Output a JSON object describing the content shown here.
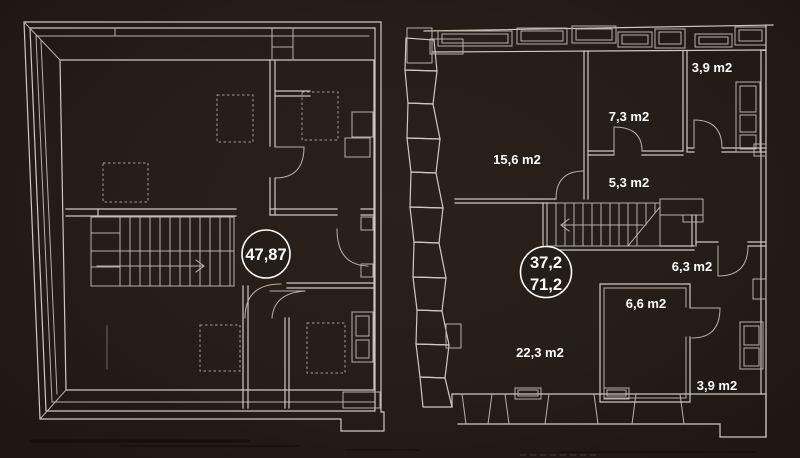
{
  "canvas": {
    "background": "#251d17",
    "line_color": "#cfc8bf",
    "text_color": "#ffffff"
  },
  "left_plan": {
    "total_area_badge": "47,87"
  },
  "right_plan": {
    "badge_line1": "37,2",
    "badge_line2": "71,2",
    "room_labels": [
      {
        "area": "3,9 m2"
      },
      {
        "area": "7,3 m2"
      },
      {
        "area": "15,6 m2"
      },
      {
        "area": "5,3 m2"
      },
      {
        "area": "6,3 m2"
      },
      {
        "area": "6,6 m2"
      },
      {
        "area": "22,3 m2"
      },
      {
        "area": "3,9 m2"
      }
    ]
  }
}
